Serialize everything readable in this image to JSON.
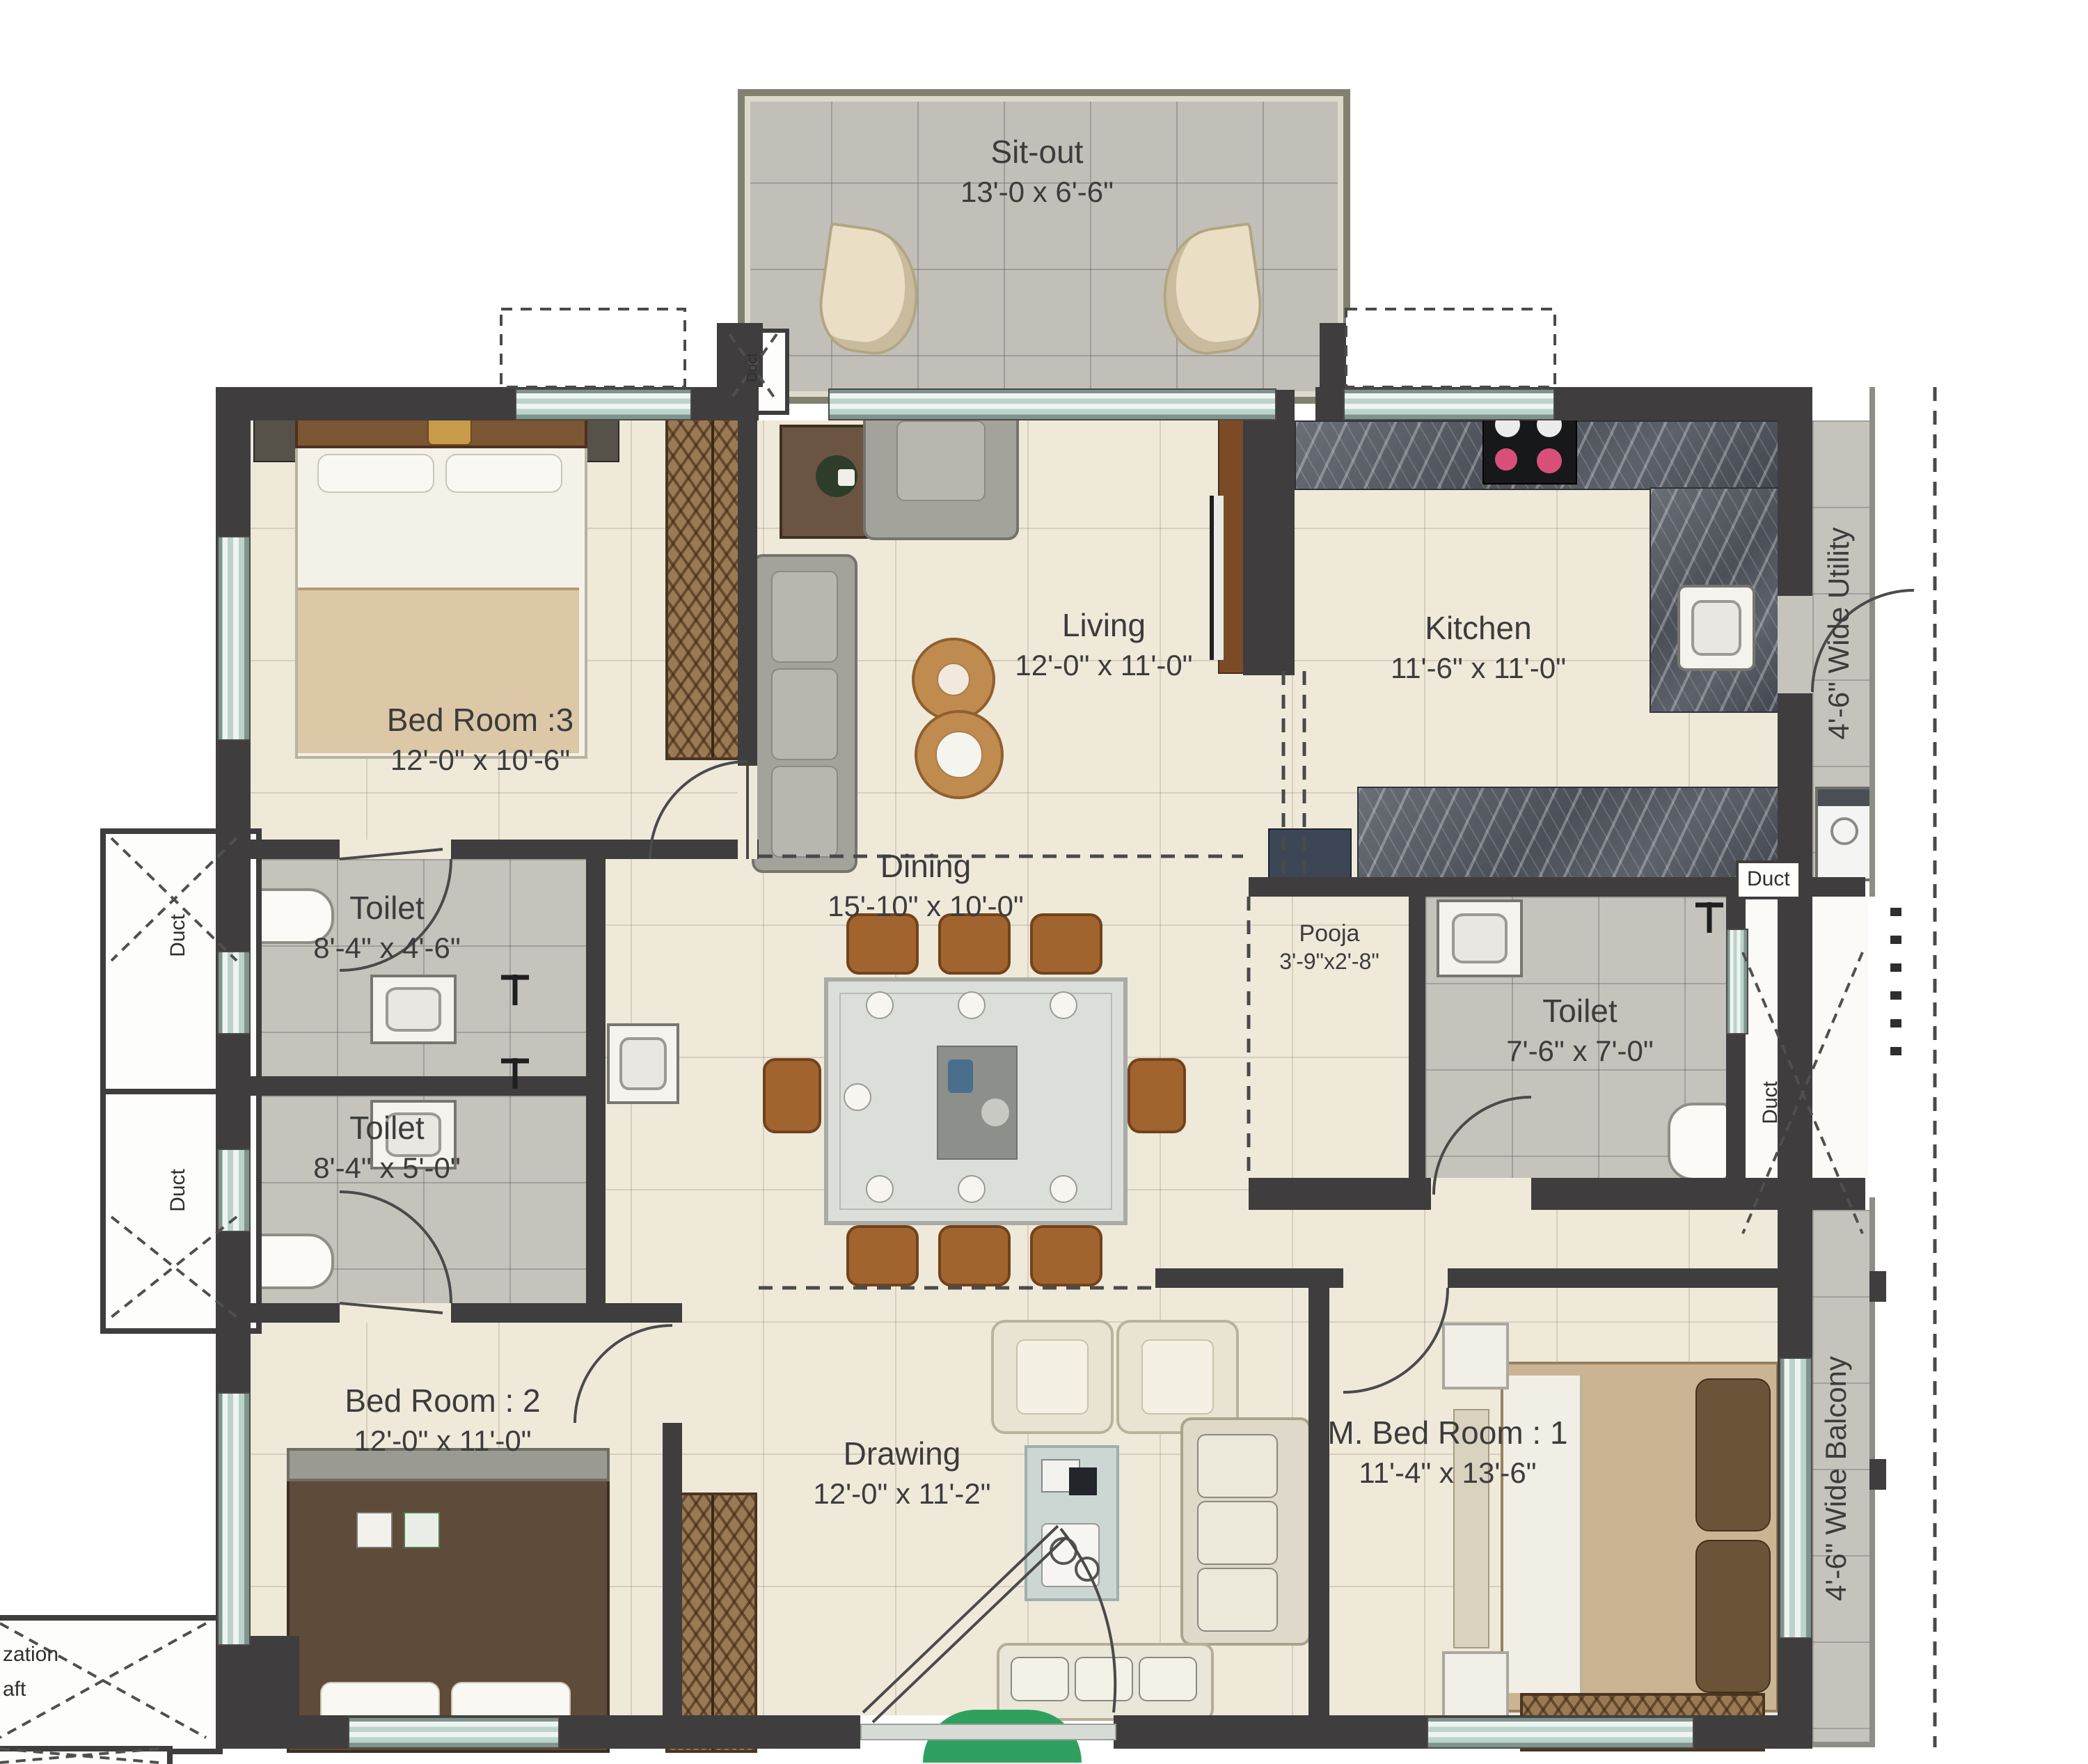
{
  "colors": {
    "wall": "#3f3d3d",
    "floor": "#efe9da",
    "tile_gray": "#c6c3bd",
    "window_glass": "#cfe0da",
    "wood": "#7a5634",
    "counter_marble": "#555a62",
    "entry_green": "#2fa05f",
    "dining_chair": "#a2642f"
  },
  "rooms": {
    "sitout": {
      "name": "Sit-out",
      "dims": "13'-0 x 6'-6\""
    },
    "bedroom3": {
      "name": "Bed Room :3",
      "dims": "12'-0\" x 10'-6\""
    },
    "living": {
      "name": "Living",
      "dims": "12'-0\" x 11'-0\""
    },
    "kitchen": {
      "name": "Kitchen",
      "dims": "11'-6\" x 11'-0\""
    },
    "utility": {
      "name": "4'-6\" Wide Utility"
    },
    "toilet_top": {
      "name": "Toilet",
      "dims": "8'-4\" x 4'-6\""
    },
    "toilet_bottom": {
      "name": "Toilet",
      "dims": "8'-4\" x 5'-0\""
    },
    "dining": {
      "name": "Dining",
      "dims": "15'-10\" x 10'-0\""
    },
    "pooja": {
      "name": "Pooja",
      "dims": "3'-9\"x2'-8\""
    },
    "toilet_master": {
      "name": "Toilet",
      "dims": "7'-6\" x 7'-0\""
    },
    "bedroom2": {
      "name": "Bed Room : 2",
      "dims": "12'-0\" x 11'-0\""
    },
    "drawing": {
      "name": "Drawing",
      "dims": "12'-0\" x 11'-2\""
    },
    "master_bedroom": {
      "name": "M. Bed Room : 1",
      "dims": "11'-4\" x 13'-6\""
    },
    "balcony": {
      "name": "4'-6\" Wide Balcony"
    }
  },
  "labels": {
    "duct": "Duct",
    "shaft_fragment_line1": "zation",
    "shaft_fragment_line2": "aft"
  }
}
